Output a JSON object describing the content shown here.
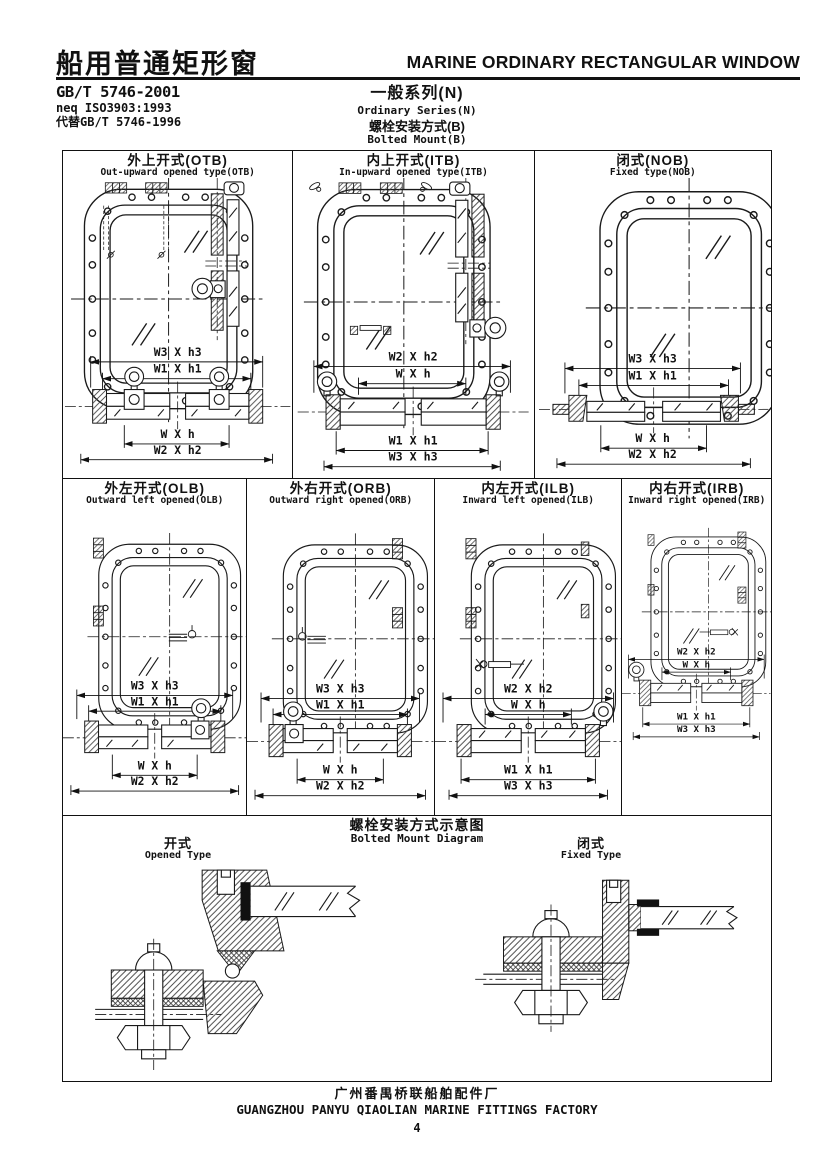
{
  "colors": {
    "ink": "#1a1a1a",
    "paper": "#ffffff"
  },
  "header": {
    "title_cn": "船用普通矩形窗",
    "title_en": "MARINE ORDINARY RECTANGULAR WINDOW",
    "standard_no": "GB/T 5746-2001",
    "standard_equiv": "neq ISO3903:1993",
    "standard_replaces": "代替GB/T 5746-1996",
    "series_cn": "一般系列(N)",
    "series_en": "Ordinary Series(N)",
    "mount_cn": "螺栓安装方式(B)",
    "mount_en": "Bolted Mount(B)"
  },
  "row1": [
    {
      "title_cn": "外上开式(OTB)",
      "title_en": "Out-upward opened type(OTB)",
      "dims_top": [
        "W3 X h3",
        "W1 X h1"
      ],
      "dims_bottom": [
        "W X h",
        "W2 X h2"
      ]
    },
    {
      "title_cn": "内上开式(ITB)",
      "title_en": "In-upward opened type(ITB)",
      "dims_top": [
        "W2 X h2",
        "W X h"
      ],
      "dims_bottom": [
        "W1 X h1",
        "W3 X h3"
      ]
    },
    {
      "title_cn": "闭式(NOB)",
      "title_en": "Fixed type(NOB)",
      "dims_top": [
        "W3 X h3",
        "W1 X h1"
      ],
      "dims_bottom": [
        "W X h",
        "W2 X h2"
      ]
    }
  ],
  "row2": [
    {
      "title_cn": "外左开式(OLB)",
      "title_en": "Outward left opened(OLB)",
      "dims_top": [
        "W3 X h3",
        "W1 X h1"
      ],
      "dims_bottom": [
        "W X h",
        "W2 X h2"
      ]
    },
    {
      "title_cn": "外右开式(ORB)",
      "title_en": "Outward right opened(ORB)",
      "dims_top": [
        "W3 X h3",
        "W1 X h1"
      ],
      "dims_bottom": [
        "W X h",
        "W2 X h2"
      ]
    },
    {
      "title_cn": "内左开式(ILB)",
      "title_en": "Inward left opened(ILB)",
      "dims_top": [
        "W2 X h2",
        "W X h"
      ],
      "dims_bottom": [
        "W1 X h1",
        "W3 X h3"
      ]
    },
    {
      "title_cn": "内右开式(IRB)",
      "title_en": "Inward right opened(IRB)",
      "dims_top": [
        "W2 X h2",
        "W X h"
      ],
      "dims_bottom": [
        "W1 X h1",
        "W3 X h3"
      ]
    }
  ],
  "diagram": {
    "title_cn": "螺栓安装方式示意图",
    "title_en": "Bolted Mount Diagram",
    "opened_cn": "开式",
    "opened_en": "Opened Type",
    "fixed_cn": "闭式",
    "fixed_en": "Fixed Type"
  },
  "footer": {
    "factory_cn": "广州番禺桥联船舶配件厂",
    "factory_en": "GUANGZHOU PANYU QIAOLIAN MARINE FITTINGS FACTORY",
    "page_number": "4"
  }
}
